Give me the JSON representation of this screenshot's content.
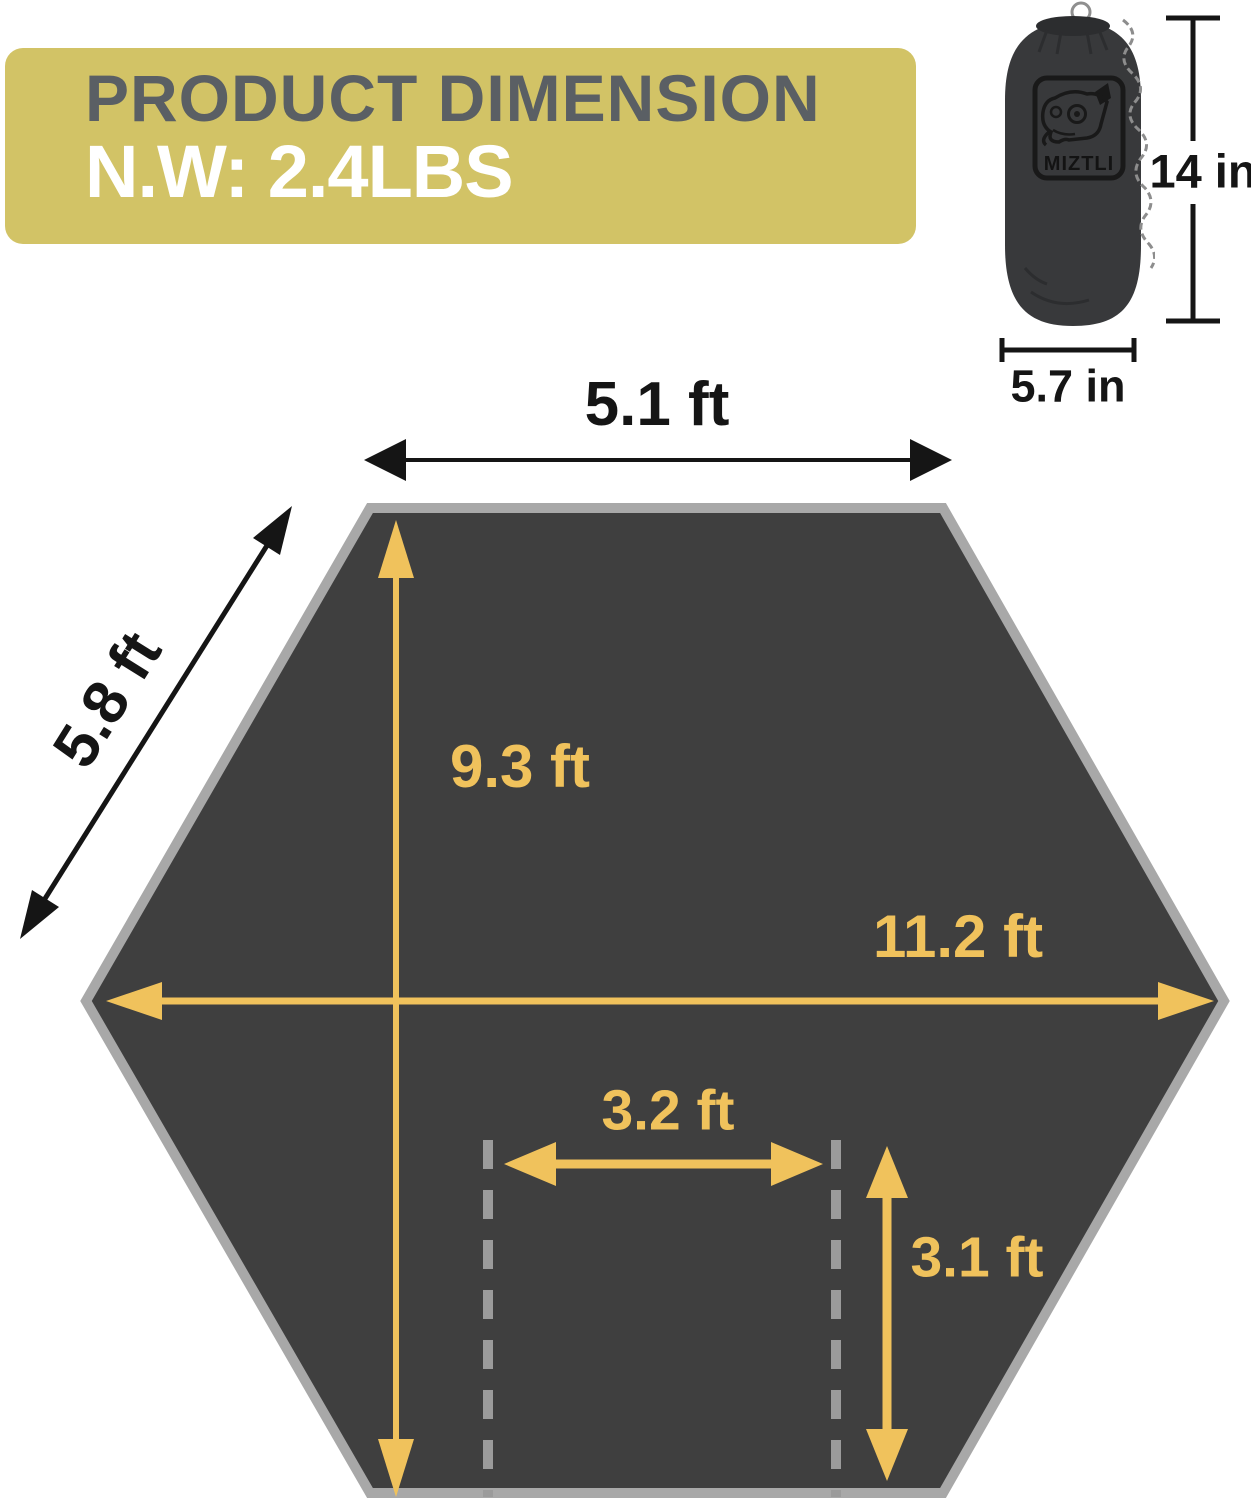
{
  "banner": {
    "title": "PRODUCT DIMENSION",
    "net_weight": "N.W: 2.4LBS"
  },
  "stuff_sack": {
    "brand": "MIZTLI",
    "height_label": "14 in",
    "width_label": "5.7 in"
  },
  "tarp": {
    "top_edge_label": "5.1 ft",
    "side_edge_label": "5.8 ft",
    "center_height_label": "9.3 ft",
    "max_width_label": "11.2 ft",
    "inner_width_label": "3.2 ft",
    "inner_height_label": "3.1 ft"
  },
  "colors": {
    "accent_yellow": "#f0c25c",
    "banner_background": "#d2c366",
    "banner_title_gray": "#5a5f64",
    "hexagon_fill": "#3f3f3f",
    "hexagon_border": "#a8a8a8",
    "dash_gray": "#9b9b9b",
    "ink_black": "#151515"
  }
}
